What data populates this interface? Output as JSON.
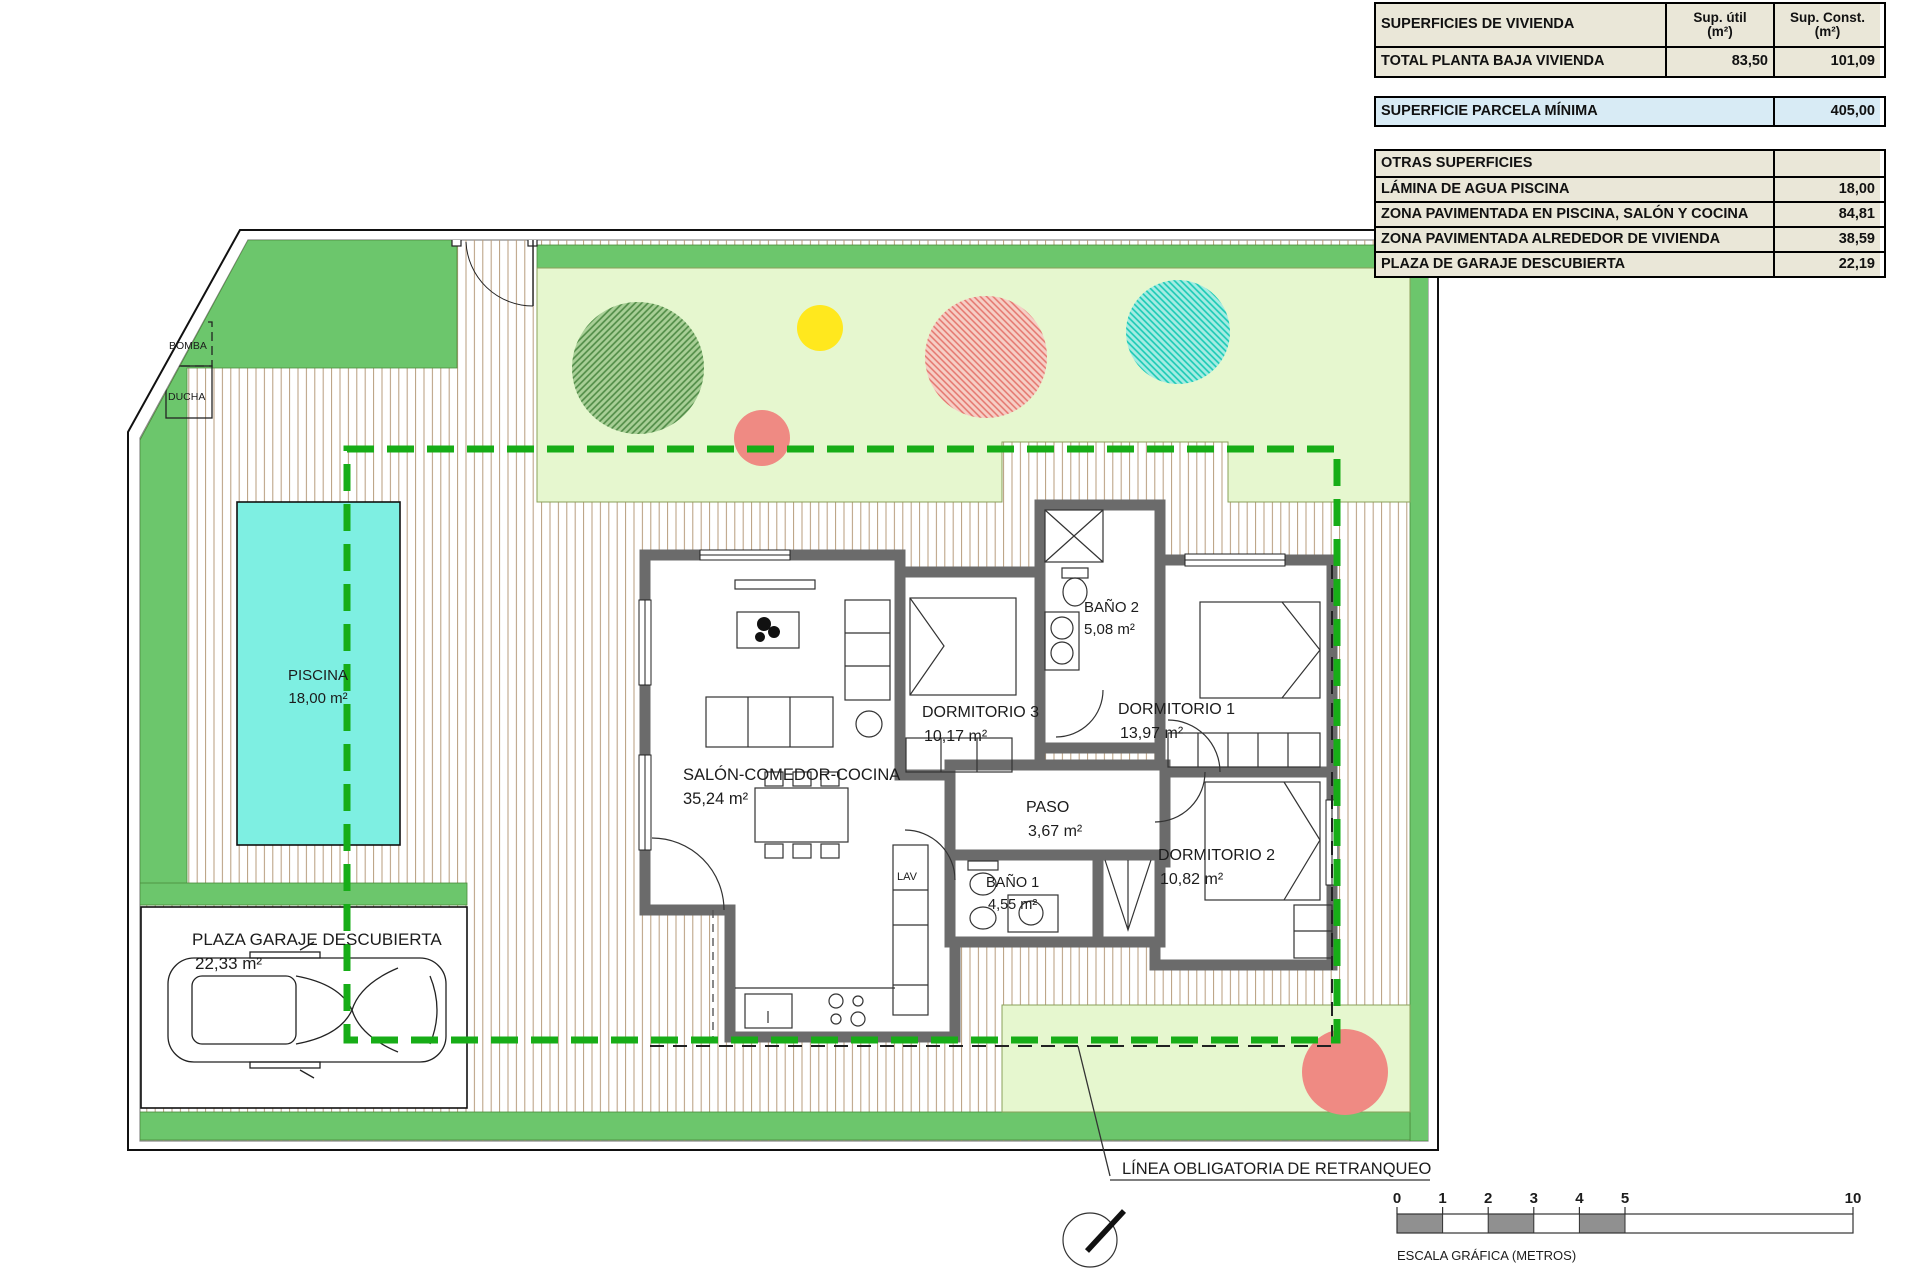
{
  "plan": {
    "pool": {
      "name": "PISCINA",
      "area": "18,00 m²"
    },
    "rooms": {
      "salon": {
        "name": "SALÓN-COMEDOR-COCINA",
        "area": "35,24 m²"
      },
      "dorm3": {
        "name": "DORMITORIO 3",
        "area": "10,17 m²"
      },
      "bano2": {
        "name": "BAÑO 2",
        "area": "5,08 m²"
      },
      "dorm1": {
        "name": "DORMITORIO 1",
        "area": "13,97 m²"
      },
      "paso": {
        "name": "PASO",
        "area": "3,67 m²"
      },
      "bano1": {
        "name": "BAÑO 1",
        "area": "4,55 m²"
      },
      "dorm2": {
        "name": "DORMITORIO 2",
        "area": "10,82 m²"
      },
      "garaje": {
        "name": "PLAZA GARAJE DESCUBIERTA",
        "area": "22,33 m²"
      }
    },
    "small_labels": {
      "bomba": "BOMBA",
      "ducha": "DUCHA",
      "lav": "LAV"
    },
    "setback_label": "LÍNEA OBLIGATORIA DE RETRANQUEO"
  },
  "tables": {
    "vivienda": {
      "header": "SUPERFICIES DE VIVIENDA",
      "col_util_1": "Sup. útil",
      "col_util_2": "(m²)",
      "col_const_1": "Sup. Const.",
      "col_const_2": "(m²)",
      "row_label": "TOTAL PLANTA BAJA VIVIENDA",
      "row_util": "83,50",
      "row_const": "101,09"
    },
    "parcela": {
      "label": "SUPERFICIE PARCELA MÍNIMA",
      "value": "405,00"
    },
    "otras": {
      "header": "OTRAS SUPERFICIES",
      "rows": [
        {
          "label": "LÁMINA DE AGUA PISCINA",
          "value": "18,00"
        },
        {
          "label": "ZONA PAVIMENTADA EN PISCINA, SALÓN Y COCINA",
          "value": "84,81"
        },
        {
          "label": "ZONA PAVIMENTADA ALREDEDOR DE VIVIENDA",
          "value": "38,59"
        },
        {
          "label": "PLAZA DE GARAJE DESCUBIERTA",
          "value": "22,19"
        }
      ]
    }
  },
  "scale_bar": {
    "ticks": [
      "0",
      "1",
      "2",
      "3",
      "4",
      "5",
      "10"
    ],
    "caption": "ESCALA GRÁFICA (METROS)"
  },
  "colors": {
    "grass_bright": "#6cc66c",
    "garden_pale": "#e6f7cf",
    "pool_water": "#7eefe2",
    "wall_gray": "#6b6b6b",
    "setback_green": "#17ad17",
    "table_beige": "#eae7d8",
    "table_blue": "#d8ebf5"
  }
}
